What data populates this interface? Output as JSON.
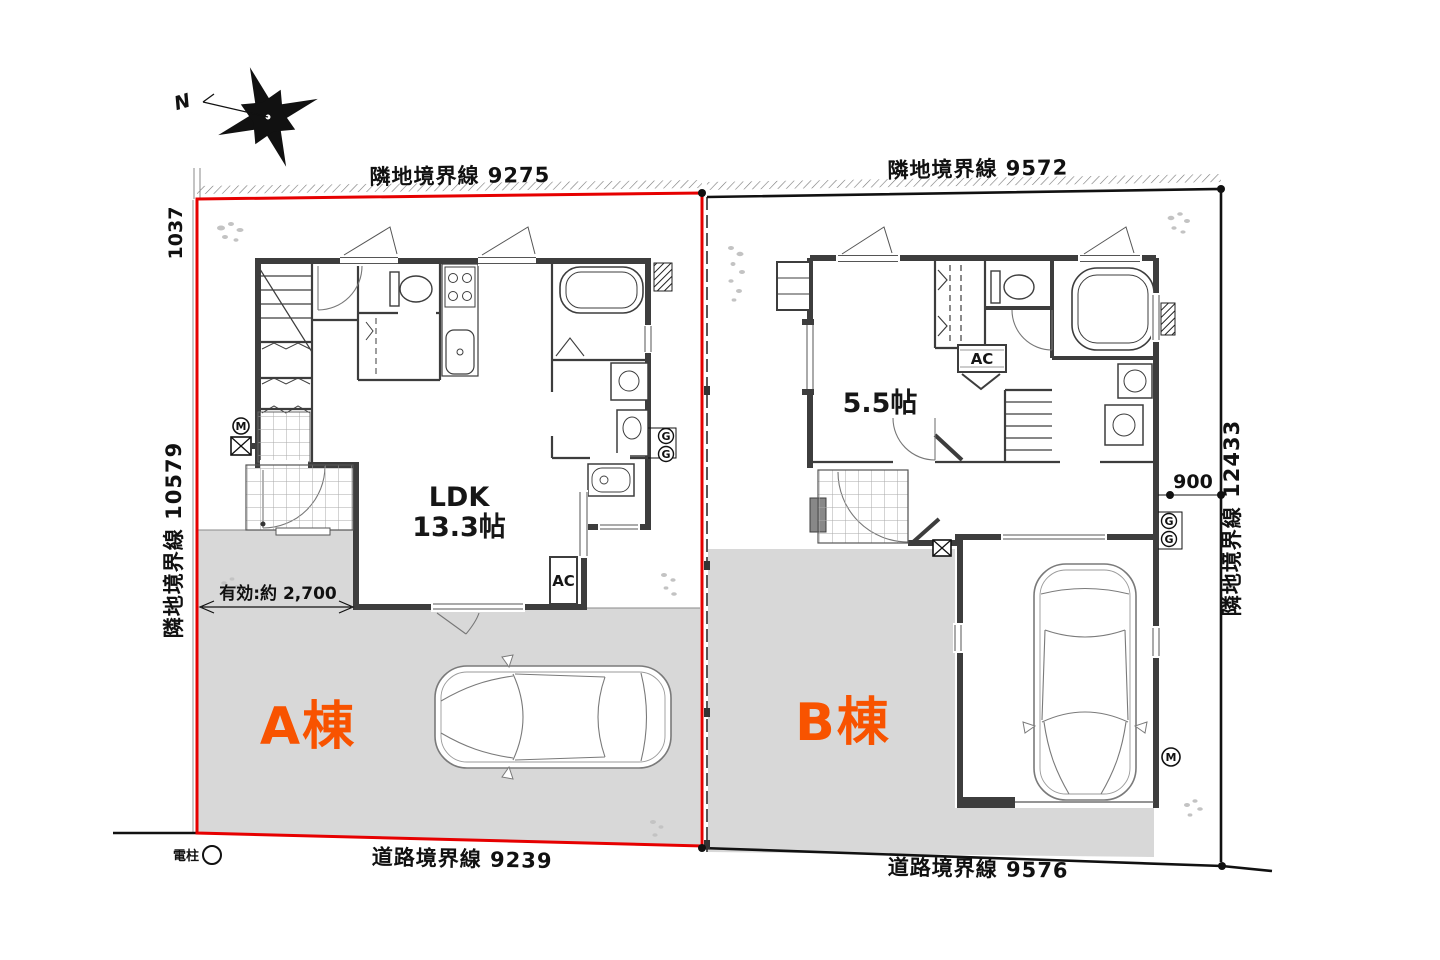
{
  "colors": {
    "lot_a_boundary_red": "#e60000",
    "lot_label_orange": "#f85300",
    "driveway_gray": "#d8d8d8",
    "wall_dark": "#3d3d3d",
    "line_black": "#111111"
  },
  "compass": {
    "north_label": "N"
  },
  "boundaries": {
    "a_top": "隣地境界線  9275",
    "a_left_offset": "1037",
    "a_left": "隣地境界線  10579",
    "a_bottom": "道路境界線  9239",
    "b_top": "隣地境界線  9572",
    "b_right": "隣地境界線  12433",
    "b_setback": "900",
    "b_bottom": "道路境界線  9576"
  },
  "site": {
    "utility_pole": "電柱"
  },
  "lot_a": {
    "name": "A棟",
    "ldk_label": "LDK",
    "ldk_size": "13.3帖",
    "effective_width": "有効:約 2,700",
    "ac_label": "AC"
  },
  "lot_b": {
    "name": "B棟",
    "room_size": "5.5帖",
    "ac_label": "AC"
  },
  "meters": {
    "electric": "M",
    "gas": "G"
  }
}
